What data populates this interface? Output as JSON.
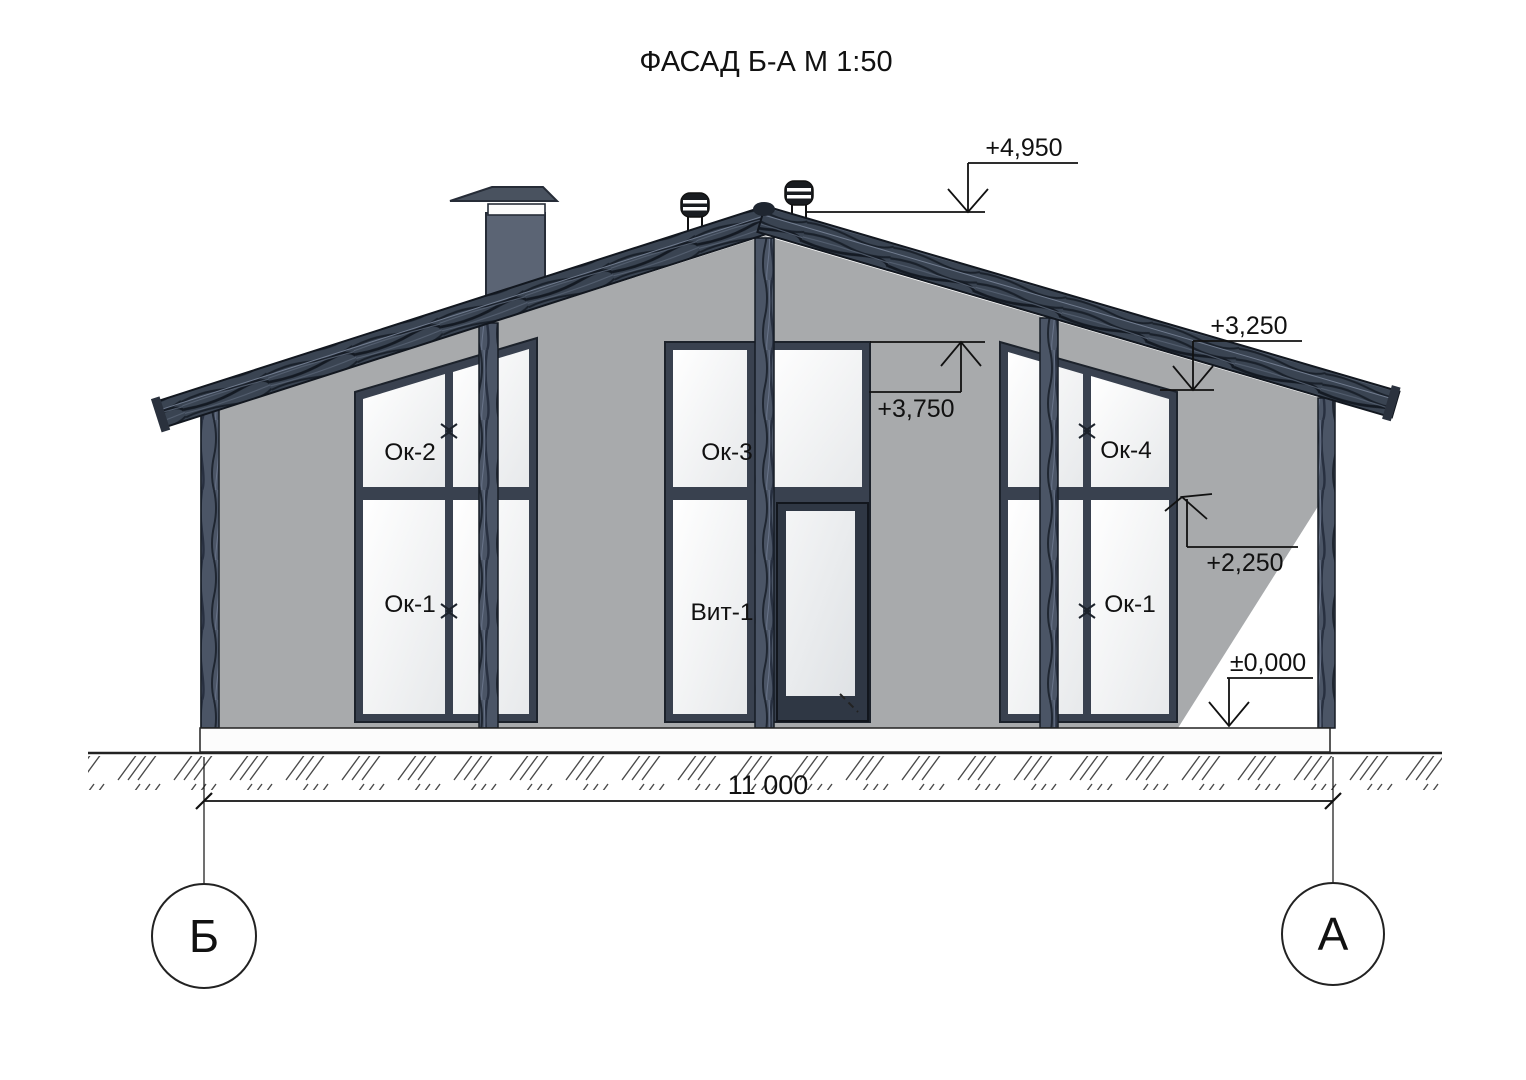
{
  "title": "ФАСАД Б-А М 1:50",
  "windows": {
    "left": {
      "top": "Ок-2",
      "bottom": "Ок-1"
    },
    "center": {
      "top": "Ок-3",
      "bottom": "Вит-1"
    },
    "right": {
      "top": "Ок-4",
      "bottom": "Ок-1"
    }
  },
  "elevations": {
    "ridge": "+4,950",
    "window_head": "+3,750",
    "eave": "+3,250",
    "transom": "+2,250",
    "ground": "±0,000"
  },
  "dimensions": {
    "width": "11 000"
  },
  "axes": {
    "left": "Б",
    "right": "А"
  },
  "colors": {
    "wall": "#a8aaac",
    "roof": "#3a4452",
    "frame": "#39414f",
    "wood_post": "#4b5566",
    "chimney": "#5b6474",
    "line": "#111111",
    "glass_light": "#ffffff",
    "glass_dark": "#e7e9eb"
  }
}
